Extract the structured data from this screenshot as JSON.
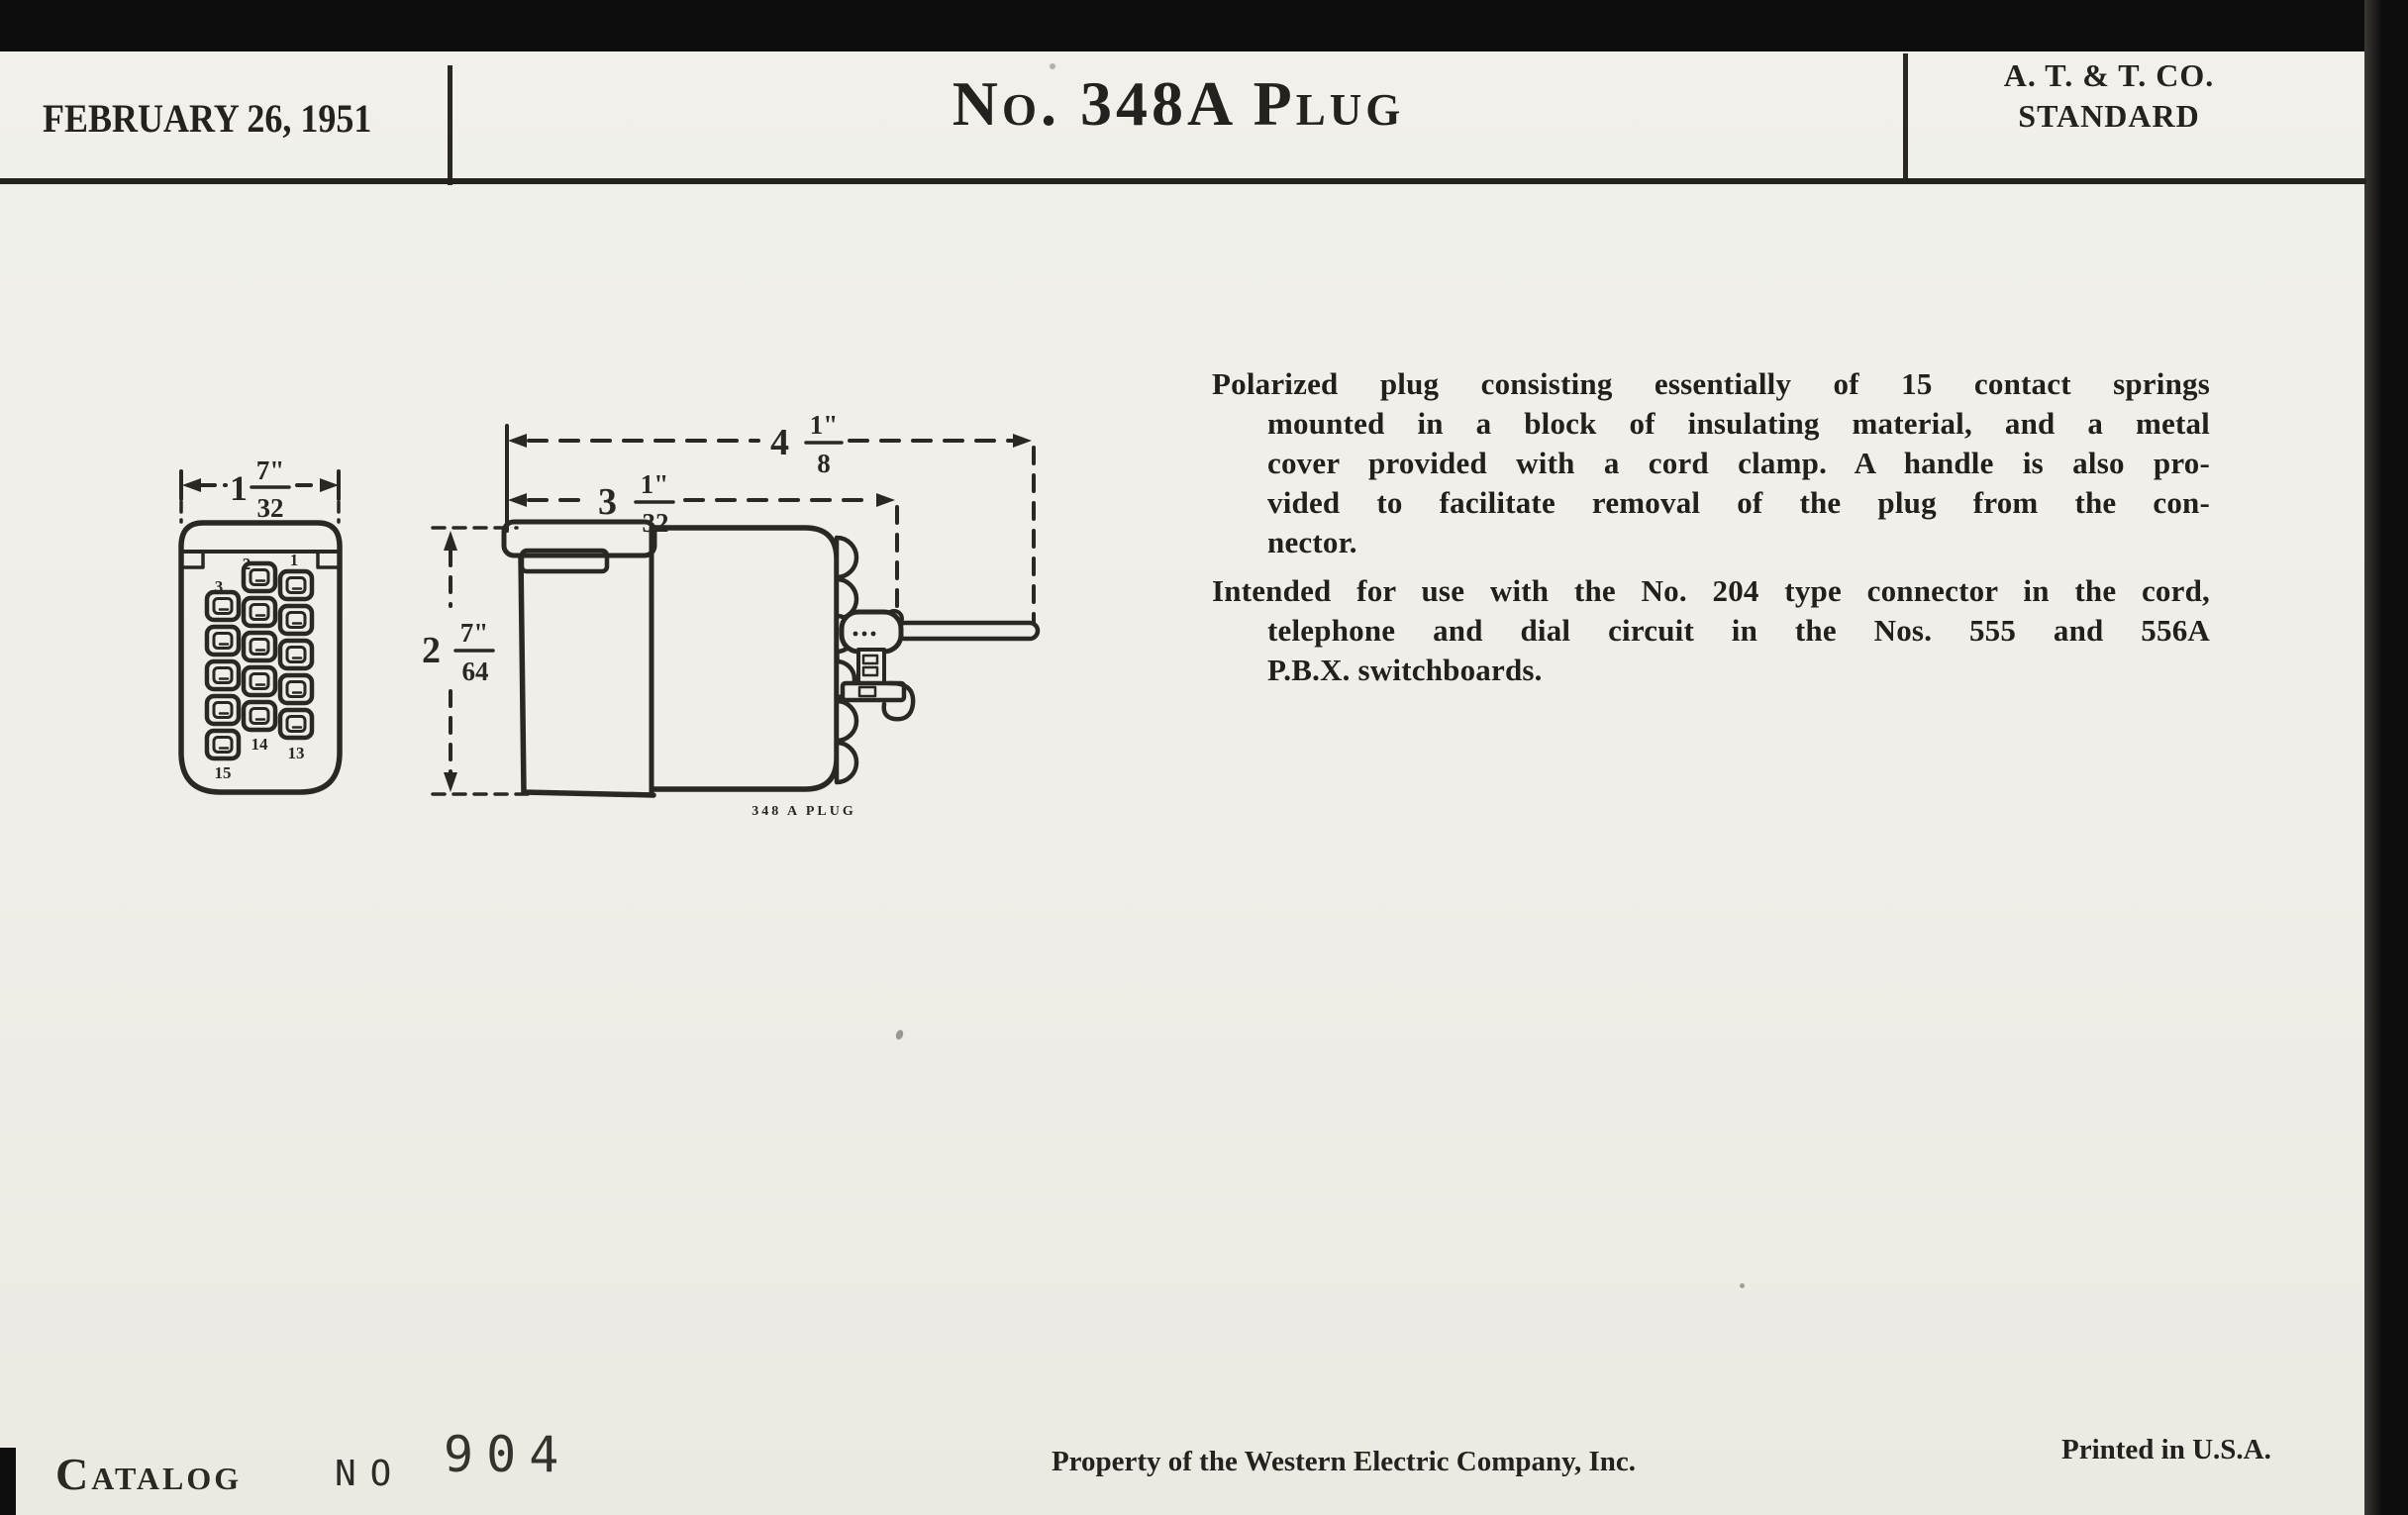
{
  "colors": {
    "paper": "#efeee8",
    "ink": "#2a2823",
    "scan_black": "#0d0d0d"
  },
  "header": {
    "date": "FEBRUARY 26, 1951",
    "title": "No. 348A Plug",
    "org_line1": "A. T. & T. CO.",
    "org_line2": "STANDARD"
  },
  "description": {
    "para1": [
      "Polarized plug consisting essentially of 15 contact springs",
      "mounted in a block of insulating material, and a metal",
      "cover provided with a cord clamp.  A handle is also pro-",
      "vided to facilitate removal of the plug from the con-",
      "nector."
    ],
    "para2": [
      "Intended for use with the No. 204 type connector in the cord,",
      "telephone and dial circuit in the Nos. 555 and 556A",
      "P.B.X. switchboards."
    ]
  },
  "figure": {
    "front": {
      "dim_width": {
        "whole": "1",
        "num": "7\"",
        "den": "32"
      },
      "contacts": {
        "top_right": "1",
        "top_mid": "2",
        "top_left": "3",
        "bottom_right": "13",
        "bottom_mid": "14",
        "bottom_left": "15"
      }
    },
    "side": {
      "dim_overall": {
        "whole": "4",
        "num": "1\"",
        "den": "8"
      },
      "dim_body": {
        "whole": "3",
        "num": "1\"",
        "den": "32"
      },
      "dim_height": {
        "whole": "2",
        "num": "7\"",
        "den": "64"
      },
      "caption": "348 A PLUG"
    }
  },
  "footer": {
    "catalog_label": "Catalog",
    "no_label": "NO",
    "number": "904",
    "property": "Property of the Western Electric Company, Inc.",
    "printed": "Printed in U.S.A."
  }
}
